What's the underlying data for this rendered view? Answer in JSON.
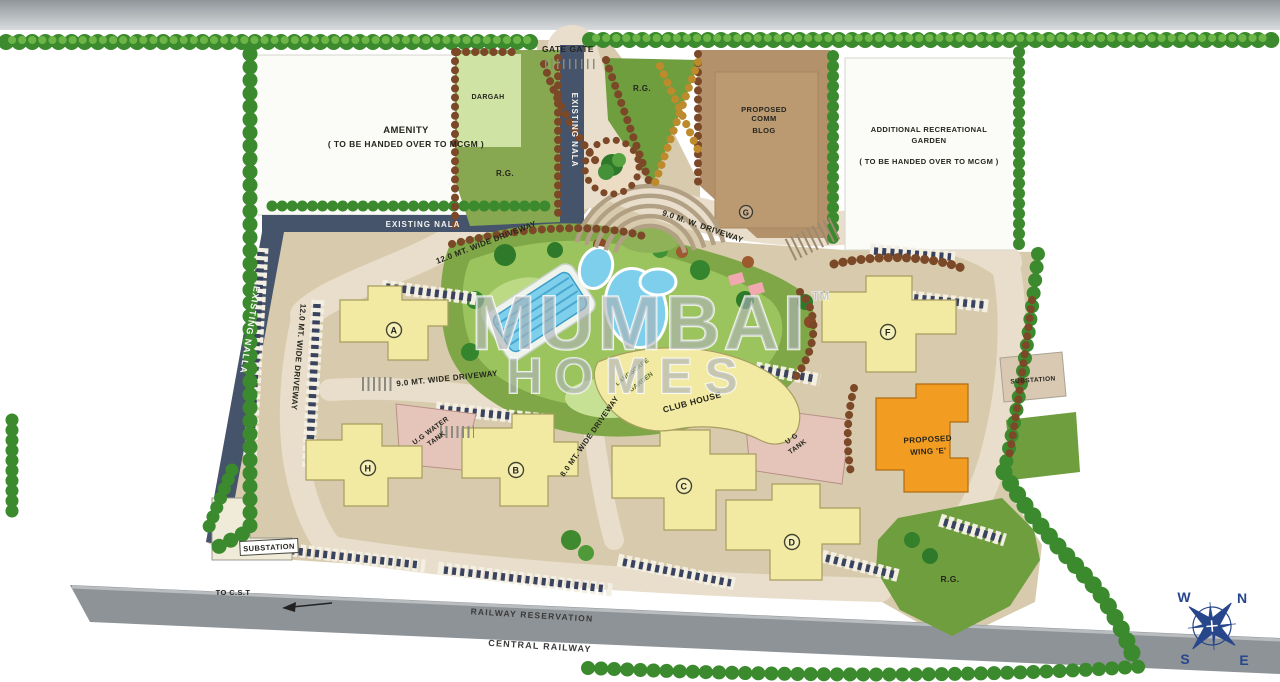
{
  "colors": {
    "ground_tan": "#d8cbad",
    "road_beige": "#e8decb",
    "building_yellow": "#f2eaa2",
    "wing_e_orange": "#f39c22",
    "pool_blue": "#7dcfeb",
    "landscape_green": "#7fa747",
    "rg_green": "#6f9e3f",
    "olive_green": "#87a751",
    "dargah_green": "#cfe3a4",
    "plot_white": "#fbfbf7",
    "comm_brown": "#b3926b",
    "nala_navy": "#45536b",
    "railway_gray": "#8e9397",
    "tank_pink": "#e5c4ba",
    "tree_green": "#3c8a2e",
    "shrub_brown": "#7b4828",
    "shrub_autumn": "#bd8a2c",
    "compass_navy": "#27468c",
    "watermark_gray": "#acb1b7"
  },
  "watermark": {
    "line1": "MUMBAI",
    "tm": "TM",
    "line2": "HOMES"
  },
  "plots": {
    "amenity_title": "AMENITY",
    "amenity_note": "( TO BE HANDED OVER TO MCGM )",
    "garden_title1": "ADDITIONAL RECREATIONAL",
    "garden_title2": "GARDEN",
    "garden_note": "( TO BE HANDED OVER TO MCGM )",
    "dargah": "DARGAH",
    "comm1": "PROPOSED",
    "comm2": "COMM",
    "comm3": "BLOG",
    "rg": "R.G.",
    "landscape1": "LANDSCAPE",
    "landscape2": "GARDEN",
    "club_house": "CLUB HOUSE"
  },
  "waterways": {
    "nala_vertical": "EXISTING NALA",
    "nala_horizontal": "EXISTING NALA",
    "nalla": "EXISTING NALLA"
  },
  "gate_label": "GATE GATE",
  "driveways": {
    "d12_top": "12.0 MT. WIDE DRIVEWAY",
    "d12_left": "12.0 MT. WIDE DRIVEWAY",
    "d9_entry": "9.0 M. W. DRIVEWAY",
    "d9_internal": "9.0 MT. WIDE DRIVEWAY",
    "d8_internal": "8.0 MT. WIDE DRIVEWAY"
  },
  "buildings": {
    "a": "A",
    "b": "B",
    "c": "C",
    "d": "D",
    "f": "F",
    "g": "G",
    "h": "H"
  },
  "wing_e": {
    "line1": "PROPOSED",
    "line2": "WING 'E'"
  },
  "tanks": {
    "water1": "U.G WATER",
    "water2": "TANK",
    "tank1": "U G",
    "tank2": "TANK"
  },
  "substations": {
    "left": "SUBSTATION",
    "right": "SUBSTATION"
  },
  "railway": {
    "reservation": "RAILWAY RESERVATION",
    "central": "CENTRAL RAILWAY",
    "to_cst": "TO C.S.T"
  },
  "compass": {
    "n": "N",
    "e": "E",
    "s": "S",
    "w": "W"
  }
}
